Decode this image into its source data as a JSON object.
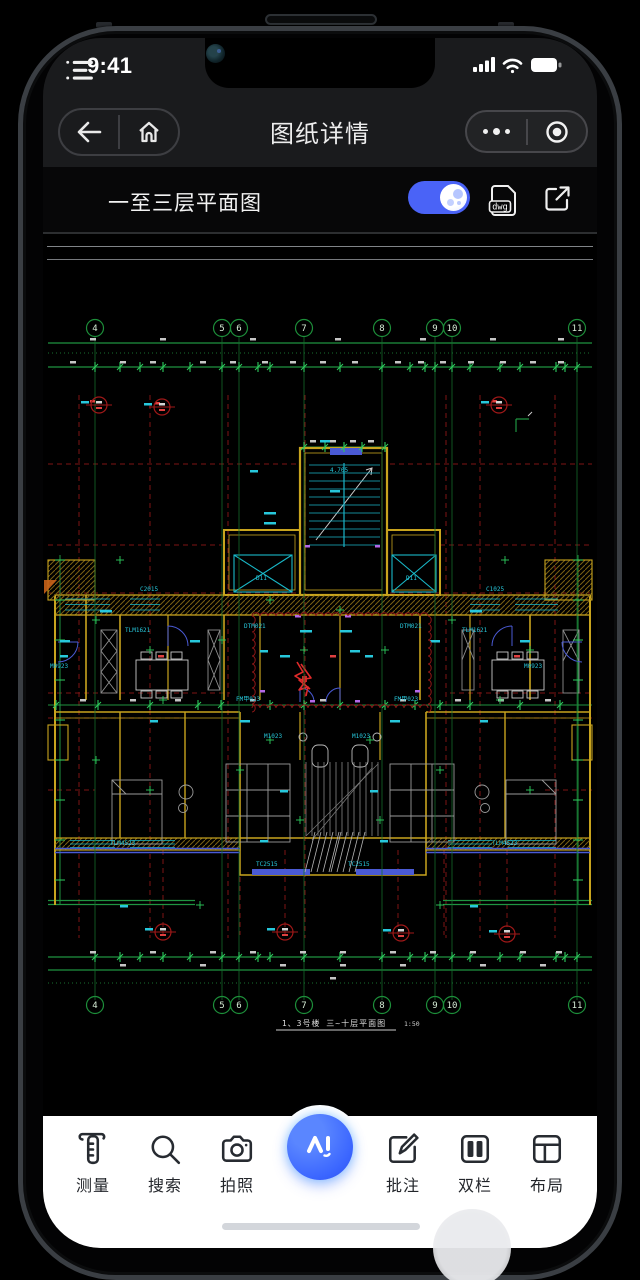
{
  "status_bar": {
    "time": "9:41"
  },
  "navbar": {
    "title": "图纸详情"
  },
  "drawing_toolbar": {
    "title": "一至三层平面图",
    "file_badge": "dwg",
    "preview_toggle_on": true
  },
  "cad": {
    "axis_numbers": [
      "4",
      "5",
      "6",
      "7",
      "8",
      "9",
      "10",
      "11"
    ],
    "axis_x": [
      95,
      222,
      239,
      304,
      382,
      435,
      452,
      577
    ],
    "caption": "1、3号楼  三~十层平面图",
    "scale": "1:50",
    "labels": [
      {
        "t": "C2015",
        "x": 140,
        "y": 591
      },
      {
        "t": "C1025",
        "x": 486,
        "y": 591
      },
      {
        "t": "TLM1621",
        "x": 125,
        "y": 632
      },
      {
        "t": "TLM1621",
        "x": 462,
        "y": 632
      },
      {
        "t": "DTM021",
        "x": 244,
        "y": 628
      },
      {
        "t": "DTM021",
        "x": 400,
        "y": 628
      },
      {
        "t": "M0923",
        "x": 50,
        "y": 668
      },
      {
        "t": "M0923",
        "x": 524,
        "y": 668
      },
      {
        "t": "FM甲023",
        "x": 236,
        "y": 701
      },
      {
        "t": "FM甲023",
        "x": 394,
        "y": 701
      },
      {
        "t": "M1023",
        "x": 264,
        "y": 738
      },
      {
        "t": "M1023",
        "x": 352,
        "y": 738
      },
      {
        "t": "TC2515",
        "x": 256,
        "y": 866
      },
      {
        "t": "TC2515",
        "x": 348,
        "y": 866
      },
      {
        "t": "TLM4523",
        "x": 110,
        "y": 845
      },
      {
        "t": "TLM4523",
        "x": 492,
        "y": 845
      },
      {
        "t": "D11",
        "x": 256,
        "y": 580
      },
      {
        "t": "D11",
        "x": 406,
        "y": 580
      },
      {
        "t": "4.705",
        "x": 330,
        "y": 472
      }
    ]
  },
  "bottom_toolbar": {
    "ai_label": "AI",
    "items": [
      {
        "id": "measure",
        "label": "测量"
      },
      {
        "id": "search",
        "label": "搜索"
      },
      {
        "id": "photo",
        "label": "拍照"
      },
      {
        "id": "annotate",
        "label": "批注"
      },
      {
        "id": "columns",
        "label": "双栏"
      },
      {
        "id": "layout",
        "label": "布局"
      }
    ]
  },
  "colors": {
    "accent_blue": "#4a63f7",
    "ai_blue": "#3b66ff",
    "green": "#1f9441",
    "dark_red": "#7e1414",
    "yellow": "#c8a41e",
    "cyan": "#27c8dc"
  }
}
